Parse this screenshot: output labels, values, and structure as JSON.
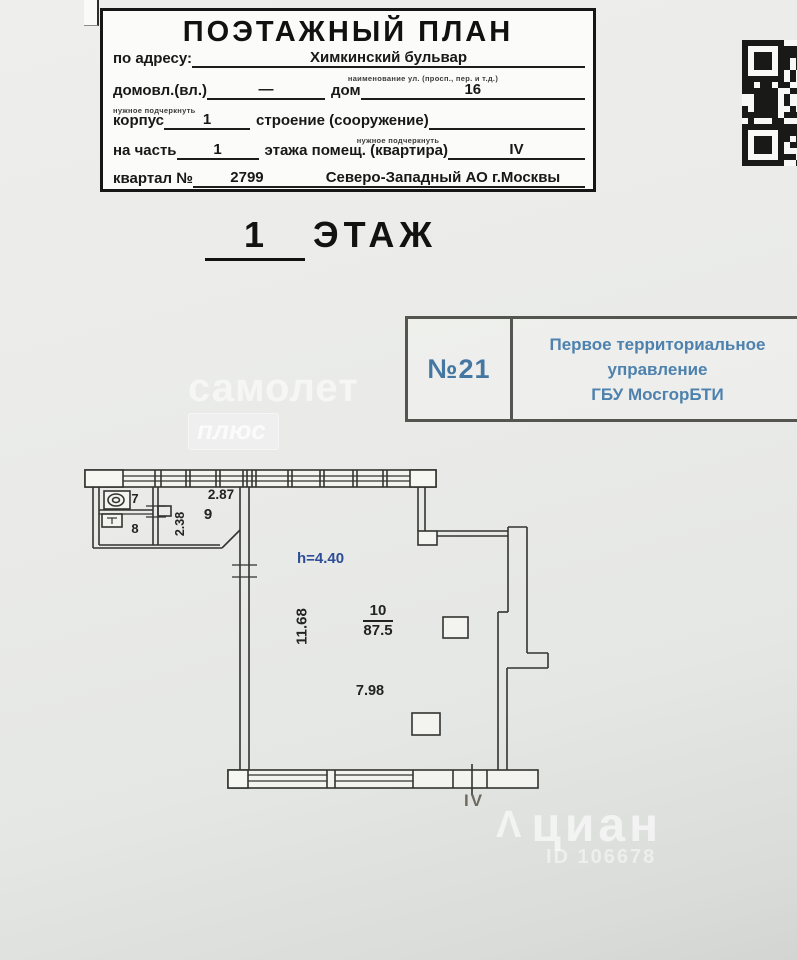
{
  "header": {
    "title": "ПОЭТАЖНЫЙ ПЛАН",
    "address_label": "по адресу:",
    "address_value": "Химкинский бульвар",
    "address_caption": "наименование ул. (просп., пер. и т.д.)",
    "domovl_label": "домовл.(вл.)",
    "domovl_value": "—",
    "domovl_caption": "нужное подчеркнуть",
    "dom_label": "дом",
    "dom_value": "16",
    "korpus_label": "корпус",
    "korpus_value": "1",
    "stroenie_label": "строение (сооружение)",
    "stroenie_value": "",
    "stroenie_caption": "нужное подчеркнуть",
    "na_chast_label": "на часть",
    "na_chast_value": "1",
    "etazha_label": "этажа помещ. (квартира)",
    "etazha_value": "IV",
    "kvartal_label": "квартал №",
    "kvartal_value": "2799",
    "okrug_value": "Северо-Западный АО г.Москвы"
  },
  "floor_title": {
    "number": "1",
    "word": "ЭТАЖ"
  },
  "stamp": {
    "number": "№21",
    "line1": "Первое территориальное",
    "line2": "управление",
    "line3": "ГБУ МосгорБТИ"
  },
  "watermark_samolet": {
    "line1": "самолет",
    "line2": "плюс"
  },
  "watermark_cian": {
    "glyph": "Λ",
    "name": "циан",
    "id_text": "ID 106678"
  },
  "plan": {
    "height_note": "h=4.40",
    "dim_top_width": "2.87",
    "dim_room9_depth": "2.38",
    "dim_left_height": "11.68",
    "dim_bottom_width": "7.98",
    "room7_number": "7",
    "room8_number": "8",
    "room9_number": "9",
    "room10_number": "10",
    "room10_area": "87.5",
    "section_label": "IV"
  },
  "colors": {
    "blue_note": "#2d4d96",
    "stamp_blue": "#4e81ad",
    "plan_line": "#33332f"
  }
}
